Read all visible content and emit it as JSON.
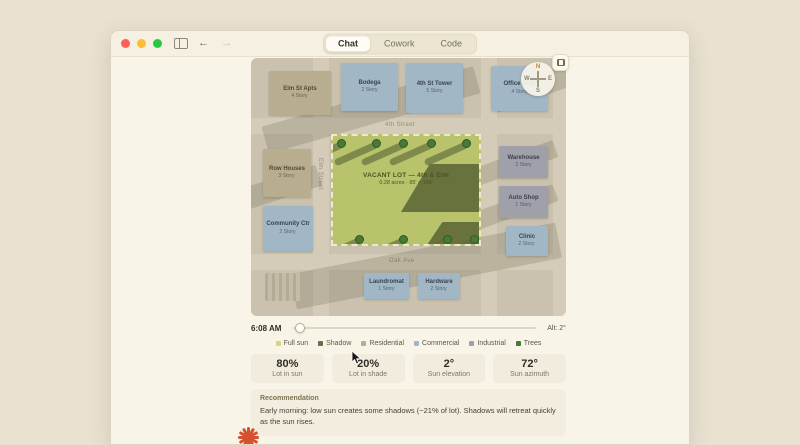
{
  "window": {
    "tabs": [
      {
        "label": "Chat",
        "active": true
      },
      {
        "label": "Cowork",
        "active": false
      },
      {
        "label": "Code",
        "active": false
      }
    ]
  },
  "map": {
    "streets": [
      {
        "name": "4th Street"
      },
      {
        "name": "Elm Street"
      },
      {
        "name": "Oak Ave"
      }
    ],
    "lot": {
      "title": "VACANT LOT — 4th & Elm",
      "subtitle": "0.28 acres · 85' × 145'"
    },
    "buildings": [
      {
        "name": "Elm St Apts",
        "floors": "4 Story",
        "type": "residential"
      },
      {
        "name": "Bodega",
        "floors": "2 Story",
        "type": "commercial"
      },
      {
        "name": "4th St Tower",
        "floors": "5 Story",
        "type": "commercial"
      },
      {
        "name": "Office Bldg",
        "floors": "4 Story",
        "type": "commercial"
      },
      {
        "name": "Row Houses",
        "floors": "3 Story",
        "type": "residential"
      },
      {
        "name": "Community Ctr",
        "floors": "2 Story",
        "type": "commercial"
      },
      {
        "name": "Warehouse",
        "floors": "2 Story",
        "type": "industrial"
      },
      {
        "name": "Auto Shop",
        "floors": "1 Story",
        "type": "industrial"
      },
      {
        "name": "Clinic",
        "floors": "2 Story",
        "type": "commercial"
      },
      {
        "name": "Laundromat",
        "floors": "1 Story",
        "type": "commercial"
      },
      {
        "name": "Hardware",
        "floors": "2 Story",
        "type": "commercial"
      }
    ],
    "compass": {
      "n": "N",
      "e": "E",
      "s": "S",
      "w": "W"
    }
  },
  "controls": {
    "time": "6:08 AM",
    "altitude": "Alt: 2°"
  },
  "legend": {
    "items": [
      {
        "label": "Full sun",
        "color": "#d9d280"
      },
      {
        "label": "Shadow",
        "color": "#68704b"
      },
      {
        "label": "Residential",
        "color": "#b9ad8f"
      },
      {
        "label": "Commercial",
        "color": "#a2b7c6"
      },
      {
        "label": "Industrial",
        "color": "#9fa0a9"
      },
      {
        "label": "Trees",
        "color": "#477a36"
      }
    ]
  },
  "stats": [
    {
      "value": "80%",
      "label": "Lot in sun"
    },
    {
      "value": "20%",
      "label": "Lot in shade"
    },
    {
      "value": "2°",
      "label": "Sun elevation"
    },
    {
      "value": "72°",
      "label": "Sun azimuth"
    }
  ],
  "recommendation": {
    "heading": "Recommendation",
    "text": "Early morning: low sun creates some shadows (~21% of lot). Shadows will retreat quickly as the sun rises."
  },
  "colors": {
    "accent": "#d4502f",
    "lot_green": "#b8c36c",
    "shadow_olive": "#5f6b3a",
    "map_base": "#cac2af",
    "window_bg": "#f8f4e7"
  }
}
